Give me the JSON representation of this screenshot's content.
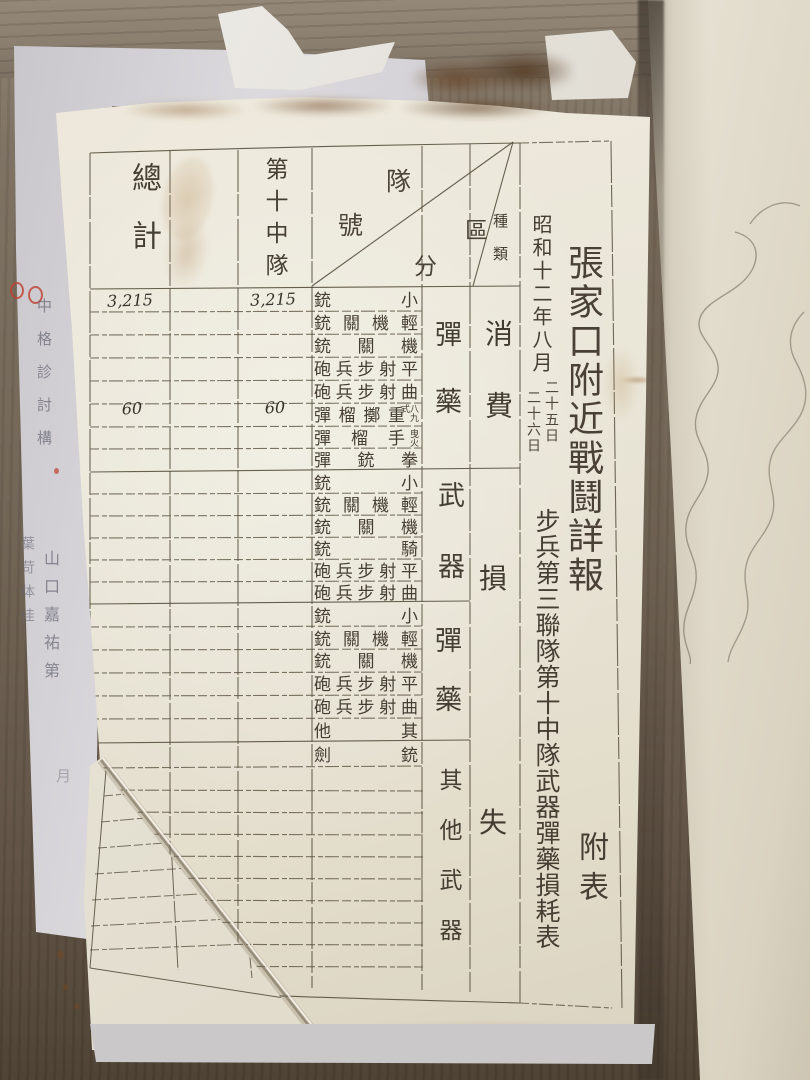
{
  "title": {
    "main": "張家口附近戰鬪詳報",
    "appendix": "附表",
    "date": "昭和十二年八月",
    "day1": "二十五日",
    "day2": "二十六日",
    "unit": "步兵第三聯隊第十中隊武器彈藥損耗表"
  },
  "table": {
    "header": {
      "total": "總計",
      "company": "第十中隊",
      "corner": {
        "c1": "隊",
        "c2": "號",
        "c3": "區",
        "c4": "分",
        "small": "種類"
      }
    },
    "groups": {
      "ammo1": "彈藥",
      "weapons": "武器",
      "ammo2": "彈藥",
      "other": "其他武器",
      "consumption": "消費",
      "loss_top": "損",
      "loss_bottom": "失"
    },
    "rows": [
      {
        "main": "銃小",
        "small": "",
        "total": "3,215",
        "company": "3,215"
      },
      {
        "main": "銃關機輕",
        "small": ""
      },
      {
        "main": "銃關機",
        "small": ""
      },
      {
        "main": "砲兵步射平",
        "small": ""
      },
      {
        "main": "砲兵步射曲",
        "small": ""
      },
      {
        "main": "彈榴擲重",
        "small": "八九式",
        "total": "60",
        "company": "60"
      },
      {
        "main": "彈榴手",
        "small": "曳火"
      },
      {
        "main": "彈銃拳",
        "small": ""
      },
      {
        "main": "銃小",
        "small": ""
      },
      {
        "main": "銃關機輕",
        "small": ""
      },
      {
        "main": "銃關機",
        "small": ""
      },
      {
        "main": "銃騎",
        "small": ""
      },
      {
        "main": "砲兵步射平",
        "small": ""
      },
      {
        "main": "砲兵步射曲",
        "small": ""
      },
      {
        "main": "銃小",
        "small": ""
      },
      {
        "main": "銃關機輕",
        "small": ""
      },
      {
        "main": "銃關機",
        "small": ""
      },
      {
        "main": "砲兵步射平",
        "small": ""
      },
      {
        "main": "砲兵步射曲",
        "small": ""
      },
      {
        "main": "他其",
        "small": ""
      },
      {
        "main": "劍銃",
        "small": ""
      }
    ]
  },
  "left_sheet": {
    "col_a": "中格診討構",
    "col_b": "葉苛体佳",
    "col_c": "山口嘉祐第",
    "col_d": "月"
  },
  "colors": {
    "page": "#eae6d8",
    "ink": "#453e32",
    "grid_line": "#57503e",
    "red_mark": "#c0402f",
    "wood": "#6f6354",
    "gray_sheet": "#d2d0d4",
    "right_page": "#e5e0d1"
  }
}
